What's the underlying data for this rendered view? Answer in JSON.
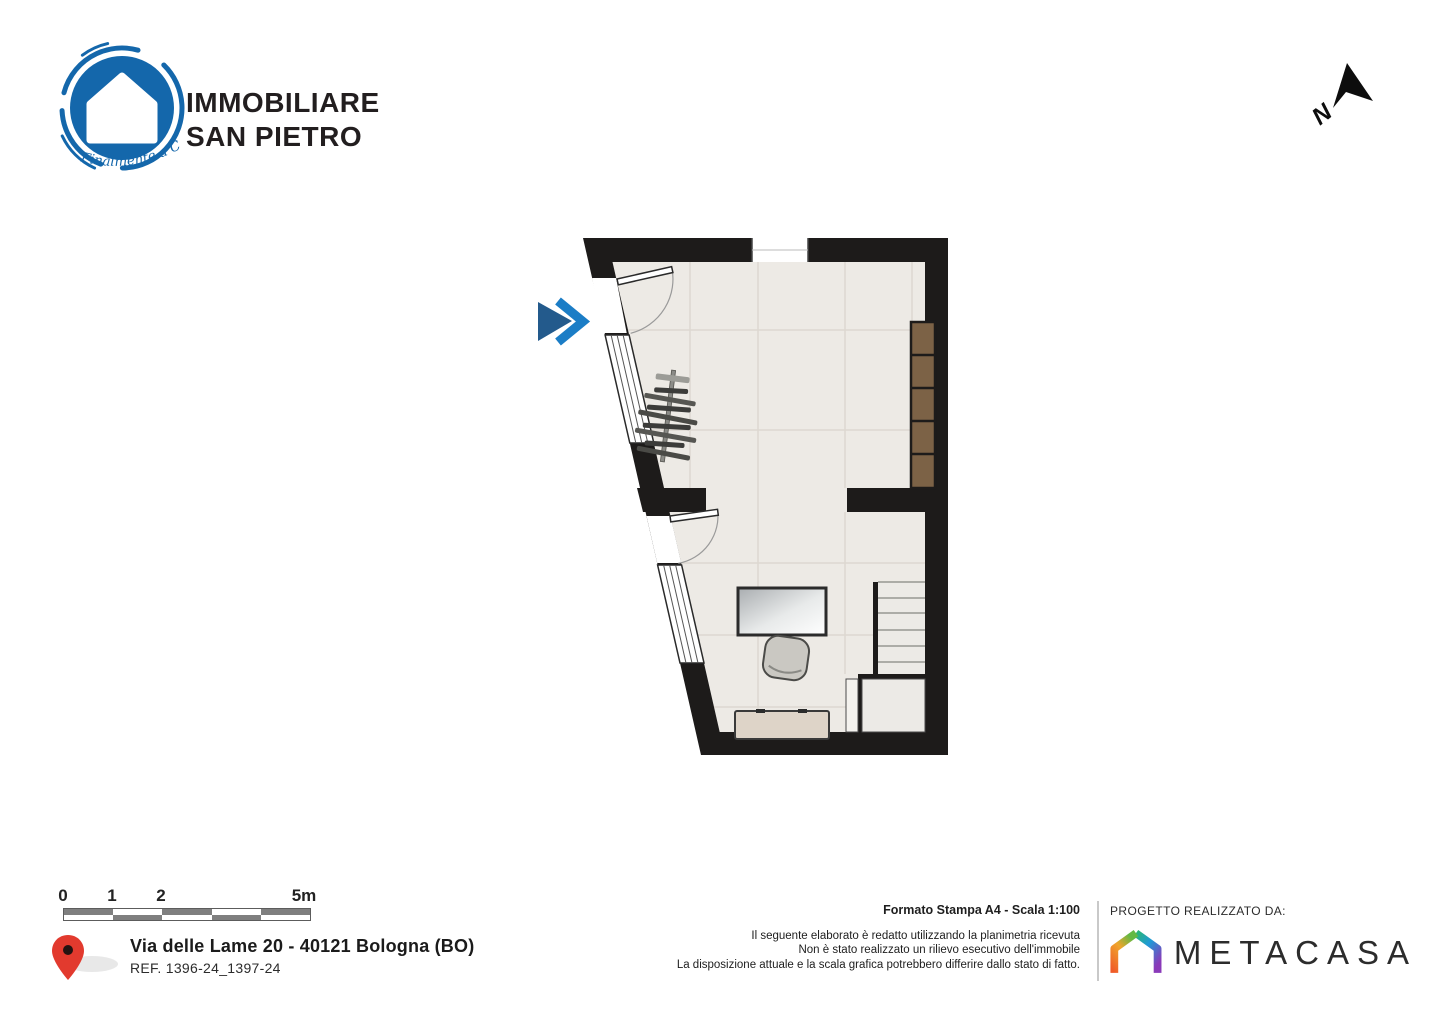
{
  "branding": {
    "name_line1": "IMMOBILIARE",
    "name_line2": "SAN PIETRO",
    "tagline": "Finalmente a Casa"
  },
  "north_arrow": {
    "label": "N"
  },
  "floor_plan": {
    "furniture_icons": [
      "entry-arrow-icon",
      "entrance-door-icon",
      "interior-door-icon",
      "window-icon",
      "clothes-rack-icon",
      "shelving-unit-icon",
      "desk-icon",
      "office-chair-icon",
      "stairs-icon",
      "sideboard-icon"
    ]
  },
  "scale_bar": {
    "labels": [
      "0",
      "1",
      "2",
      "5m"
    ]
  },
  "location": {
    "address": "Via delle Lame 20 - 40121 Bologna (BO)",
    "reference": "REF. 1396-24_1397-24"
  },
  "print_info": {
    "format": "Formato Stampa A4 - Scala 1:100",
    "disclaimer": [
      "Il seguente elaborato è redatto utilizzando la planimetria ricevuta",
      "Non è stato realizzato un rilievo esecutivo dell'immobile",
      "La disposizione attuale e la scala grafica potrebbero differire dallo stato di fatto."
    ]
  },
  "credits": {
    "label": "PROGETTO REALIZZATO DA:",
    "company": "METACASA"
  },
  "colors": {
    "brand_blue": "#1467ab",
    "wall": "#1d1b1a",
    "floor": "#edeae5",
    "grid_line": "#ddd8d1",
    "wood": "#7c6246",
    "pin_red": "#e23a2e",
    "entry_arrow_dark": "#235a8c",
    "entry_arrow_light": "#1b7dc6",
    "metacasa_green": "#63b944",
    "metacasa_blue": "#1f9ad7",
    "metacasa_purple": "#9a35b5",
    "metacasa_magenta": "#e0368c",
    "metacasa_orange": "#f05a28"
  }
}
